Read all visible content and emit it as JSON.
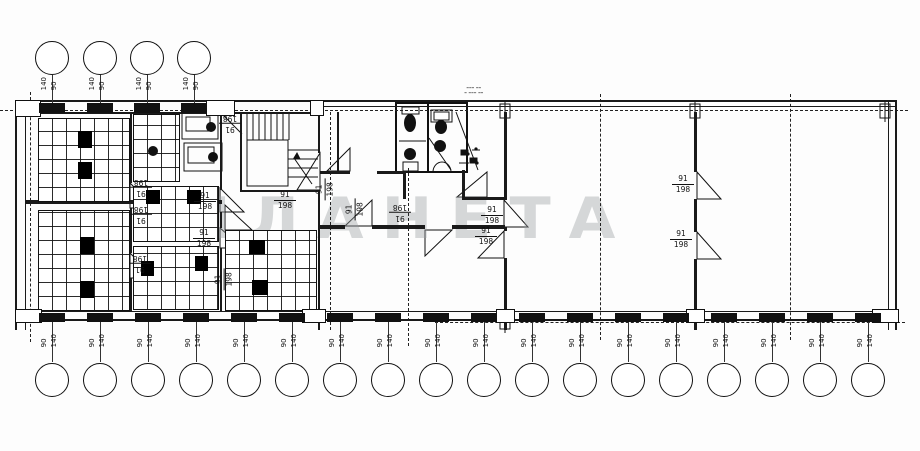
{
  "watermark": "ПЛАНЕТА",
  "door_label": {
    "width": "91",
    "height": "198"
  },
  "window_label_top": {
    "left": "140",
    "right": "90"
  },
  "window_label_bottom": {
    "left": "90",
    "right": "140"
  },
  "annotation": {
    "line1": "━━━ ━━",
    "line2": "━ ━━━ ━━"
  }
}
